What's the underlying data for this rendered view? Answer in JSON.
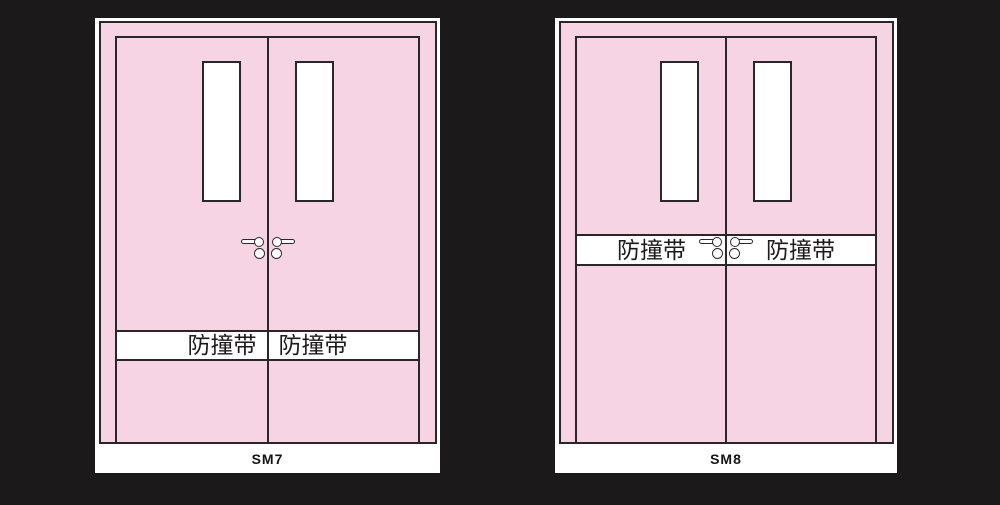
{
  "page": {
    "background_color": "#1c191b",
    "description_colors": {
      "door_pink": "#f7d4e4",
      "outline_black": "#2b262a",
      "panel_white": "#ffffff",
      "label_text": "#151314"
    }
  },
  "figures": [
    {
      "name": "SM7",
      "label": "SM7",
      "band": {
        "position": "lower",
        "left_text": "防撞带",
        "right_text": "防撞带"
      }
    },
    {
      "name": "SM8",
      "label": "SM8",
      "band": {
        "position": "middle",
        "left_text": "防撞带",
        "right_text": "防撞带"
      }
    }
  ]
}
